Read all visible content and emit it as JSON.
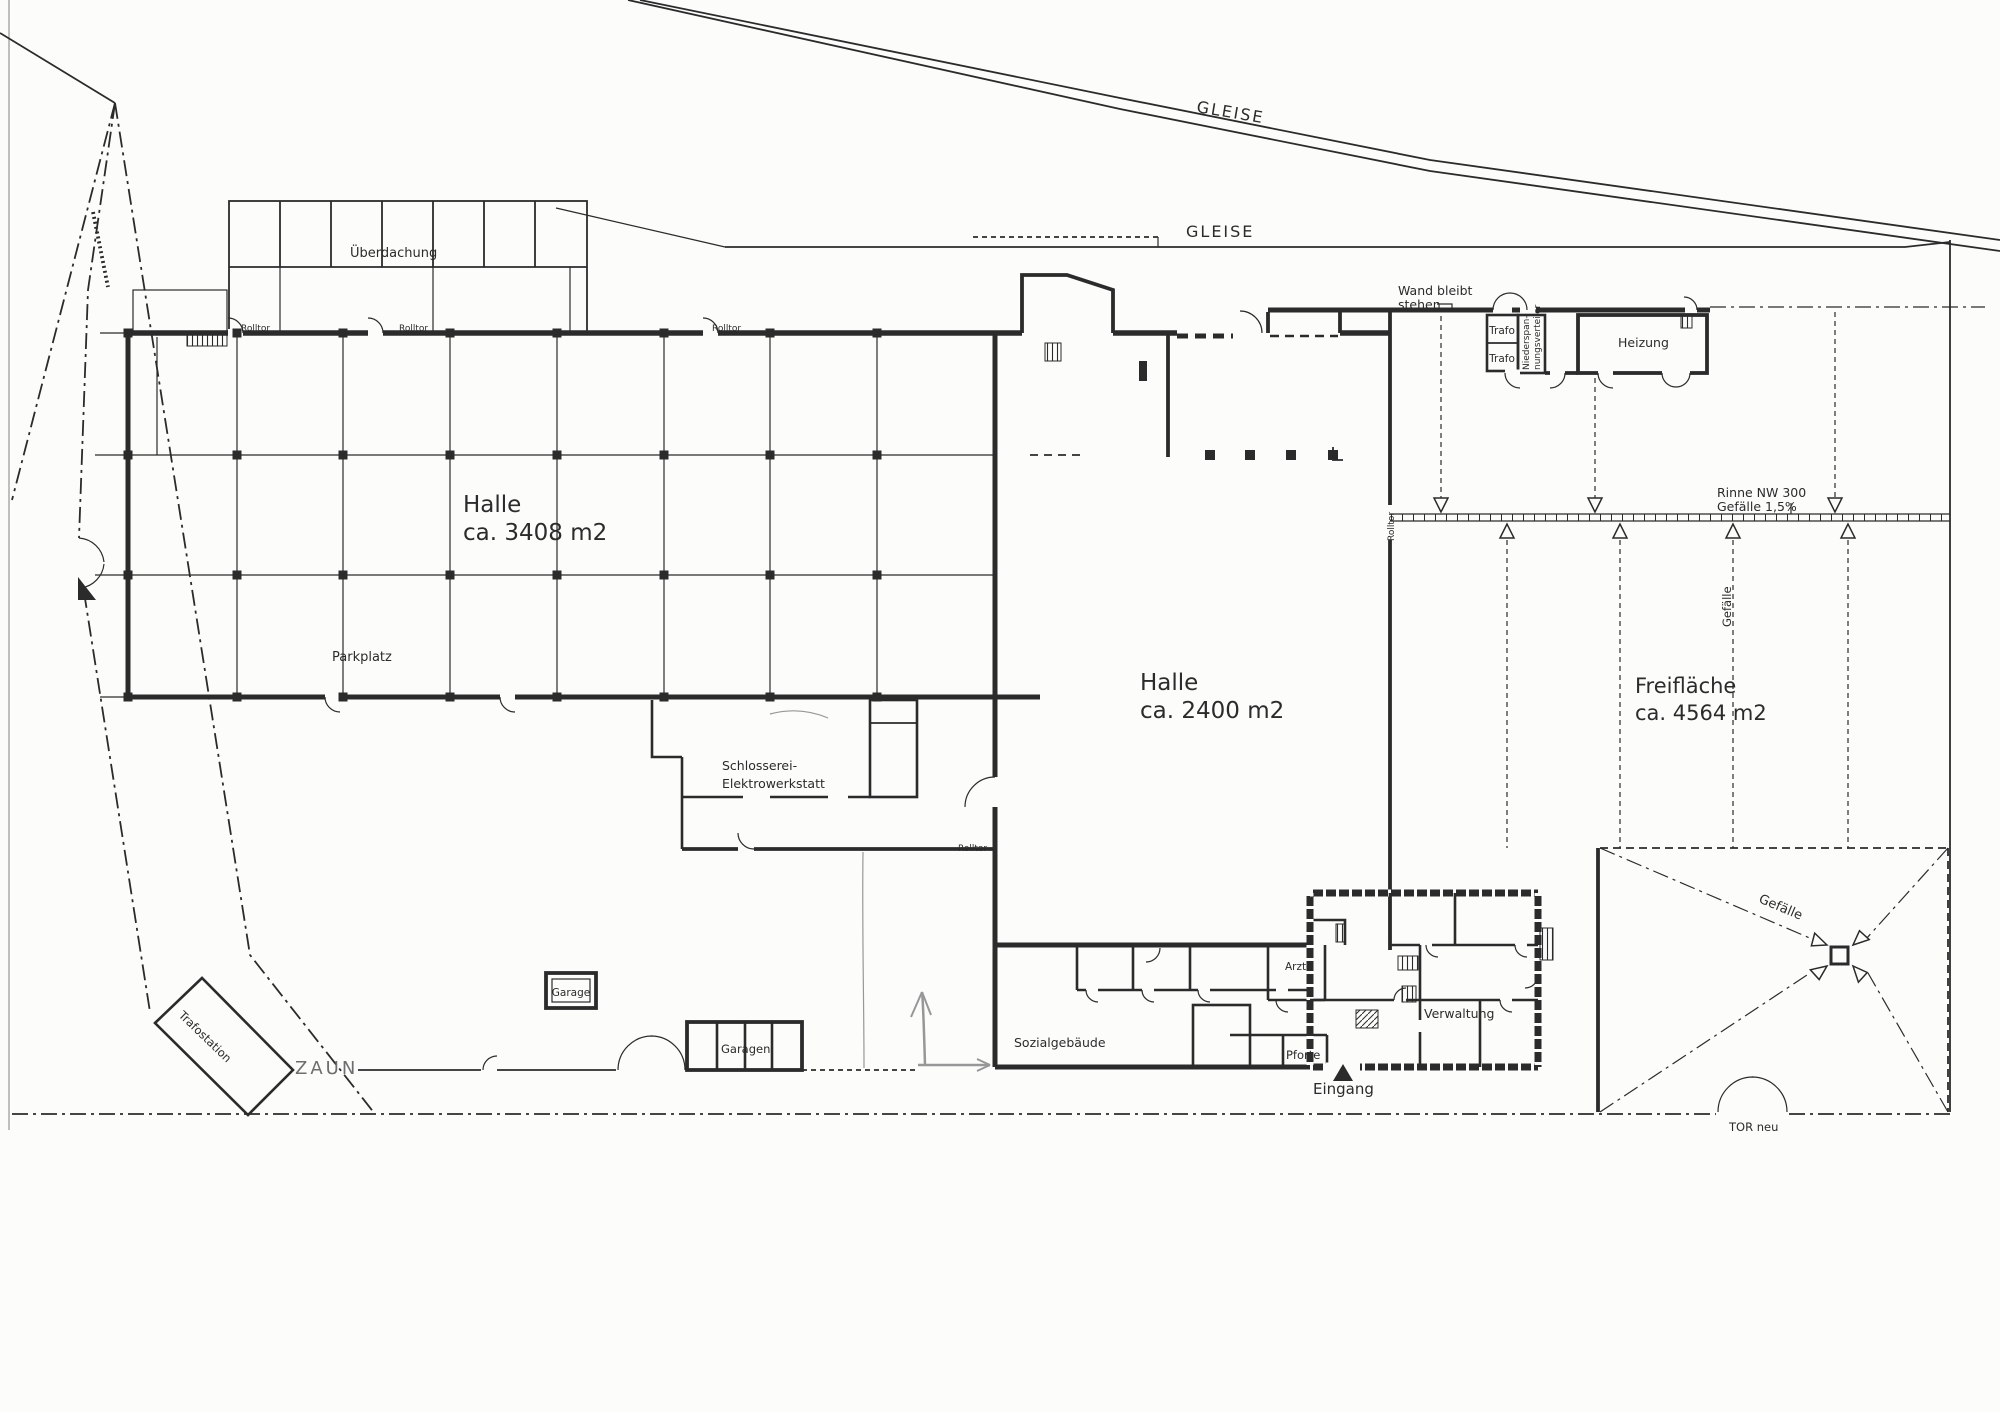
{
  "railway": {
    "label": "GLEISE"
  },
  "canopy": {
    "label": "Überdachung"
  },
  "halls": {
    "hall_west": {
      "name": "Halle",
      "area": "ca. 3408 m2"
    },
    "hall_middle": {
      "name": "Halle",
      "area": "ca. 2400 m2"
    },
    "open_area": {
      "name": "Freifläche",
      "area": "ca. 4564 m2"
    }
  },
  "rooms": {
    "schlosserei_line1": "Schlosserei-",
    "schlosserei_line2": "Elektrowerkstatt",
    "trafo": "Trafo",
    "nsv_line1": "Niederspan-",
    "nsv_line2": "nungsverteiler",
    "heizung": "Heizung",
    "sozialgebaeude": "Sozialgebäude",
    "arztzimmer": "Arztr.",
    "pforte": "Pforte",
    "verwaltung": "Verwaltung"
  },
  "site": {
    "parkplatz": "Parkplatz",
    "garage": "Garage",
    "garagen": "Garagen",
    "trafostation": "Trafostation",
    "zaun": "ZAUN",
    "eingang": "Eingang",
    "tor_neu": "TOR neu",
    "rolltor": "Rolltor"
  },
  "annotations": {
    "wand_line1": "Wand bleibt",
    "wand_line2": "stehen",
    "rinne_line1": "Rinne NW 300",
    "rinne_line2": "Gefälle 1,5%",
    "gefaelle": "Gefälle"
  },
  "colors": {
    "ink": "#2b2b2b",
    "paper": "#fcfcfa",
    "pencil": "#979797"
  }
}
